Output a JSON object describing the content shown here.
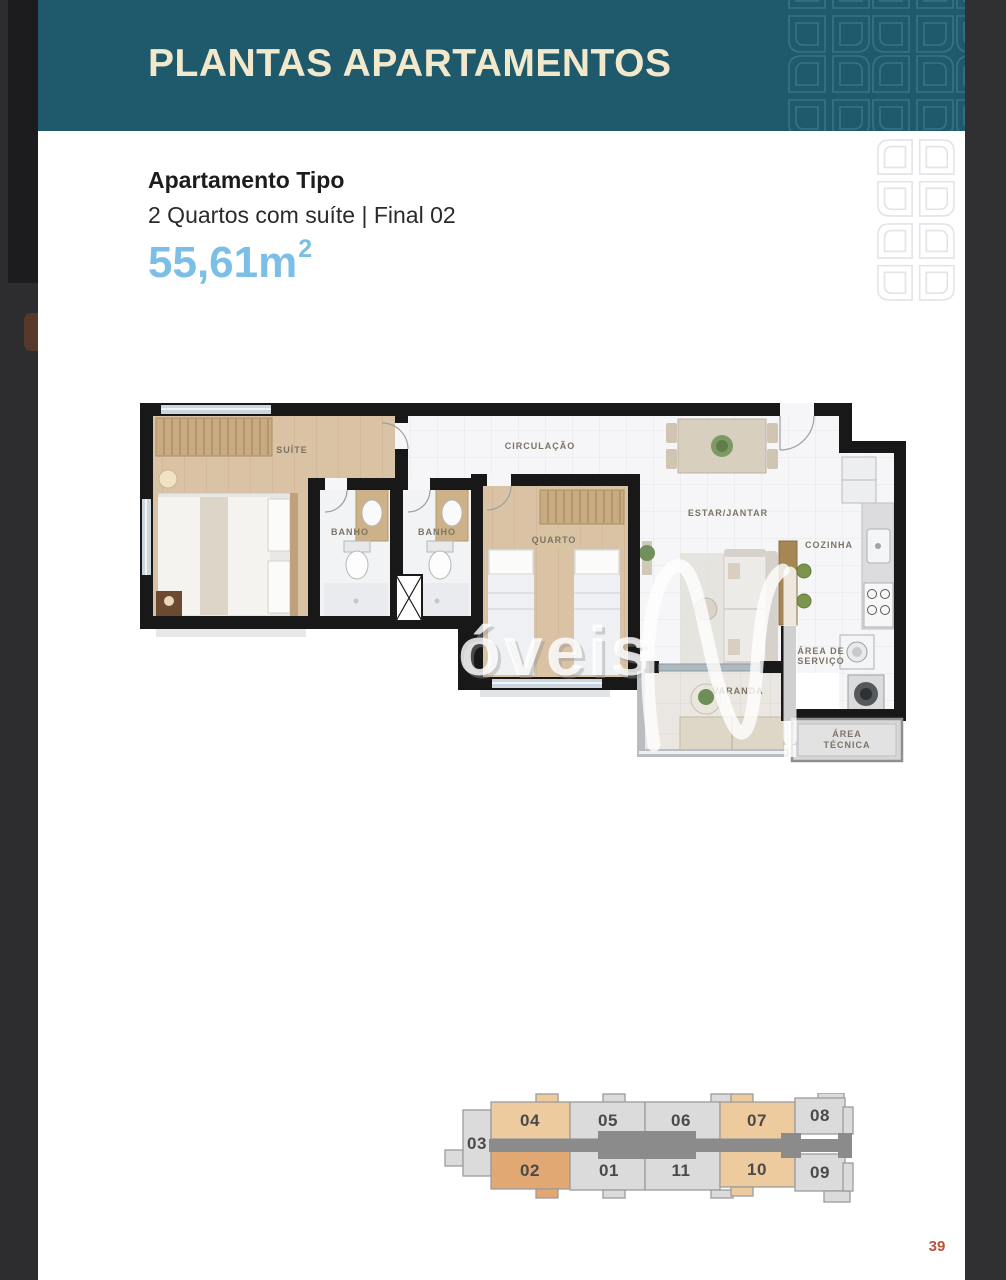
{
  "header": {
    "title": "PLANTAS APARTAMENTOS",
    "background_color": "#1f5a6c",
    "title_color": "#f2e9cc"
  },
  "apartment": {
    "type_label": "Apartamento Tipo",
    "description": "2 Quartos com suíte | Final 02",
    "area_value": "55,61",
    "area_unit": "m",
    "area_exponent": "2",
    "area_color": "#7bbfe6"
  },
  "floor_plan": {
    "labels": {
      "suite": "SUÍTE",
      "banho_1": "BANHO",
      "banho_2": "BANHO",
      "quarto": "QUARTO",
      "circulacao": "CIRCULAÇÃO",
      "estar_jantar": "ESTAR/JANTAR",
      "cozinha": "COZINHA",
      "area_servico_line1": "ÁREA DE",
      "area_servico_line2": "SERVIÇO",
      "varanda": "VARANDA",
      "area_tecnica_line1": "ÁREA",
      "area_tecnica_line2": "TÉCNICA"
    },
    "watermark_text": "óveis",
    "watermark_logo": "n-swoosh-watermark"
  },
  "key_plan": {
    "highlight_color": "#eecb9e",
    "selected_color": "#e1a873",
    "unit_color": "#dbdbdb",
    "corridor_color": "#8b8b8b",
    "units": {
      "u03": {
        "number": "03",
        "highlighted": false
      },
      "u04": {
        "number": "04",
        "highlighted": true
      },
      "u05": {
        "number": "05",
        "highlighted": false
      },
      "u06": {
        "number": "06",
        "highlighted": false
      },
      "u07": {
        "number": "07",
        "highlighted": true
      },
      "u08": {
        "number": "08",
        "highlighted": false
      },
      "u02": {
        "number": "02",
        "highlighted": true
      },
      "u01": {
        "number": "01",
        "highlighted": false
      },
      "u11": {
        "number": "11",
        "highlighted": false
      },
      "u10": {
        "number": "10",
        "highlighted": true
      },
      "u09": {
        "number": "09",
        "highlighted": false
      }
    }
  },
  "page_number": "39"
}
